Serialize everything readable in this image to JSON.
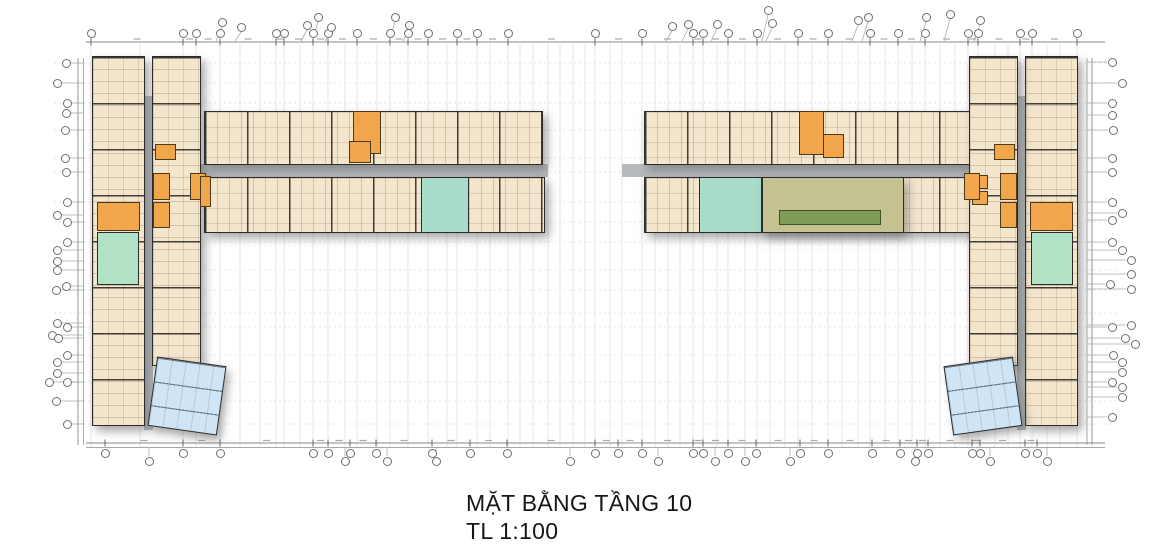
{
  "title_block": {
    "line1": "MẶT BẰNG TẦNG 10",
    "line2": "TL 1:100"
  },
  "colors": {
    "beige": "#f4e5cd",
    "wall": "#2b2b2b",
    "gray": "#b7babd",
    "orange": "#f1a64c",
    "mint": "#b2e2c5",
    "teal": "#a8dccb",
    "olive": "#c4c290",
    "balcony": "#7e9c55",
    "blue": "#cfe4f4",
    "grid": "#dcdcdc",
    "dim": "#8a8a8a",
    "tick": "#555555",
    "leader": "#aaaaaa"
  },
  "plan": {
    "blocks": [
      {
        "name": "left-wing-corridor",
        "x": 144,
        "y": 96,
        "w": 9,
        "h": 334,
        "c": "gray"
      },
      {
        "name": "left-wing-west-column",
        "x": 92,
        "y": 56,
        "w": 53,
        "h": 370,
        "c": "beige",
        "tex": "h",
        "shadow": true
      },
      {
        "name": "left-wing-east-column",
        "x": 152,
        "y": 56,
        "w": 49,
        "h": 310,
        "c": "beige",
        "tex": "h",
        "shadow": true
      },
      {
        "name": "left-wing-stair-core",
        "x": 97,
        "y": 202,
        "w": 43,
        "h": 29,
        "c": "orange"
      },
      {
        "name": "left-wing-green-unit",
        "x": 97,
        "y": 232,
        "w": 42,
        "h": 53,
        "c": "mint"
      },
      {
        "name": "left-wing-lobby",
        "x": 171,
        "y": 173,
        "w": 18,
        "h": 55,
        "c": "gray"
      },
      {
        "name": "left-wing-elevator-a",
        "x": 153,
        "y": 173,
        "w": 17,
        "h": 27,
        "c": "orange"
      },
      {
        "name": "left-wing-elevator-b",
        "x": 190,
        "y": 173,
        "w": 16,
        "h": 27,
        "c": "orange"
      },
      {
        "name": "left-wing-elevator-c",
        "x": 153,
        "y": 202,
        "w": 17,
        "h": 26,
        "c": "orange"
      },
      {
        "name": "left-wing-service-box",
        "x": 155,
        "y": 144,
        "w": 21,
        "h": 16,
        "c": "orange"
      },
      {
        "name": "left-wing-blue-unit",
        "x": 152,
        "y": 361,
        "w": 70,
        "h": 70,
        "c": "blue",
        "tex": "hl",
        "rot": 8,
        "shadow": true
      },
      {
        "name": "north-wing-left-corridor",
        "x": 144,
        "y": 164,
        "w": 404,
        "h": 13,
        "c": "gray"
      },
      {
        "name": "north-wing-left-top-row",
        "x": 204,
        "y": 111,
        "w": 339,
        "h": 54,
        "c": "beige",
        "tex": "v",
        "shadow": true
      },
      {
        "name": "north-wing-left-bottom-row",
        "x": 204,
        "y": 177,
        "w": 341,
        "h": 56,
        "c": "beige",
        "tex": "v",
        "shadow": true
      },
      {
        "name": "north-wing-left-stair-core",
        "x": 353,
        "y": 111,
        "w": 28,
        "h": 43,
        "c": "orange"
      },
      {
        "name": "north-wing-left-stair-landing",
        "x": 349,
        "y": 141,
        "w": 22,
        "h": 22,
        "c": "orange"
      },
      {
        "name": "north-wing-left-teal-unit",
        "x": 421,
        "y": 177,
        "w": 48,
        "h": 56,
        "c": "teal"
      },
      {
        "name": "north-wing-left-service-box",
        "x": 200,
        "y": 176,
        "w": 11,
        "h": 31,
        "c": "orange"
      },
      {
        "name": "north-wing-right-corridor",
        "x": 622,
        "y": 164,
        "w": 398,
        "h": 13,
        "c": "gray"
      },
      {
        "name": "north-wing-right-top-row",
        "x": 644,
        "y": 111,
        "w": 336,
        "h": 54,
        "c": "beige",
        "tex": "v",
        "shadow": true
      },
      {
        "name": "north-wing-right-bottom-row",
        "x": 644,
        "y": 177,
        "w": 336,
        "h": 56,
        "c": "beige",
        "tex": "v",
        "shadow": true
      },
      {
        "name": "north-wing-right-stair-core",
        "x": 799,
        "y": 111,
        "w": 25,
        "h": 44,
        "c": "orange"
      },
      {
        "name": "north-wing-right-stair-landing",
        "x": 823,
        "y": 134,
        "w": 21,
        "h": 24,
        "c": "orange"
      },
      {
        "name": "north-wing-right-teal-unit",
        "x": 699,
        "y": 177,
        "w": 63,
        "h": 56,
        "c": "teal"
      },
      {
        "name": "north-wing-right-olive-unit",
        "x": 762,
        "y": 177,
        "w": 142,
        "h": 56,
        "c": "olive",
        "shadow": true
      },
      {
        "name": "north-wing-right-olive-balcony",
        "x": 779,
        "y": 210,
        "w": 102,
        "h": 15,
        "c": "balcony"
      },
      {
        "name": "north-wing-right-elevator-a",
        "x": 972,
        "y": 175,
        "w": 16,
        "h": 14,
        "c": "orange"
      },
      {
        "name": "north-wing-right-elevator-b",
        "x": 972,
        "y": 191,
        "w": 16,
        "h": 14,
        "c": "orange"
      },
      {
        "name": "right-wing-corridor",
        "x": 1017,
        "y": 96,
        "w": 9,
        "h": 334,
        "c": "gray"
      },
      {
        "name": "right-wing-east-column",
        "x": 1025,
        "y": 56,
        "w": 53,
        "h": 370,
        "c": "beige",
        "tex": "h",
        "shadow": true
      },
      {
        "name": "right-wing-west-column",
        "x": 969,
        "y": 56,
        "w": 49,
        "h": 310,
        "c": "beige",
        "tex": "h",
        "shadow": true
      },
      {
        "name": "right-wing-stair-core",
        "x": 1030,
        "y": 202,
        "w": 43,
        "h": 29,
        "c": "orange"
      },
      {
        "name": "right-wing-green-unit",
        "x": 1031,
        "y": 232,
        "w": 42,
        "h": 53,
        "c": "mint"
      },
      {
        "name": "right-wing-lobby",
        "x": 981,
        "y": 173,
        "w": 18,
        "h": 55,
        "c": "gray"
      },
      {
        "name": "right-wing-elevator-a",
        "x": 1000,
        "y": 173,
        "w": 17,
        "h": 27,
        "c": "orange"
      },
      {
        "name": "right-wing-elevator-b",
        "x": 964,
        "y": 173,
        "w": 16,
        "h": 27,
        "c": "orange"
      },
      {
        "name": "right-wing-elevator-c",
        "x": 1000,
        "y": 202,
        "w": 17,
        "h": 26,
        "c": "orange"
      },
      {
        "name": "right-wing-service-box",
        "x": 994,
        "y": 144,
        "w": 21,
        "h": 16,
        "c": "orange"
      },
      {
        "name": "right-wing-blue-unit",
        "x": 948,
        "y": 361,
        "w": 70,
        "h": 70,
        "c": "blue",
        "tex": "hl",
        "rot": -8,
        "shadow": true
      }
    ]
  },
  "grid": {
    "vlines": [
      91,
      140,
      183,
      196,
      220,
      240,
      260,
      276,
      284,
      300,
      313,
      328,
      345,
      357,
      377,
      390,
      408,
      428,
      447,
      457,
      477,
      490,
      508,
      520,
      533,
      548,
      560,
      573,
      585,
      595,
      610,
      622,
      642,
      655,
      668,
      680,
      693,
      703,
      717,
      728,
      745,
      757,
      770,
      785,
      798,
      812,
      828,
      842,
      858,
      870,
      885,
      898,
      912,
      925,
      940,
      955,
      968,
      978,
      995,
      1008,
      1020,
      1032,
      1047,
      1060,
      1077
    ],
    "hlines": [
      63,
      83,
      103,
      130,
      158,
      172,
      202,
      222,
      242,
      270,
      290,
      313,
      327,
      355,
      382,
      401,
      424
    ],
    "top_bubbles": [
      91,
      183,
      196,
      220,
      276,
      284,
      313,
      328,
      357,
      390,
      408,
      428,
      457,
      477,
      508,
      595,
      642,
      693,
      703,
      728,
      757,
      798,
      828,
      870,
      898,
      925,
      968,
      978,
      1020,
      1032,
      1077
    ],
    "top_elevated": [
      {
        "x": 222,
        "y": 22
      },
      {
        "x": 241,
        "y": 27
      },
      {
        "x": 307,
        "y": 25
      },
      {
        "x": 318,
        "y": 17
      },
      {
        "x": 331,
        "y": 27
      },
      {
        "x": 395,
        "y": 17
      },
      {
        "x": 409,
        "y": 25
      },
      {
        "x": 672,
        "y": 26
      },
      {
        "x": 688,
        "y": 24
      },
      {
        "x": 717,
        "y": 24
      },
      {
        "x": 768,
        "y": 10
      },
      {
        "x": 772,
        "y": 23
      },
      {
        "x": 858,
        "y": 20
      },
      {
        "x": 868,
        "y": 17
      },
      {
        "x": 926,
        "y": 17
      },
      {
        "x": 950,
        "y": 14
      },
      {
        "x": 980,
        "y": 20
      }
    ],
    "bottom_bubbles": [
      105,
      183,
      220,
      313,
      328,
      350,
      376,
      432,
      470,
      507,
      595,
      618,
      642,
      693,
      703,
      728,
      756,
      800,
      828,
      872,
      900,
      917,
      928,
      972,
      980,
      1025,
      1037
    ],
    "bottom_dropped": [
      149,
      345,
      387,
      436,
      570,
      658,
      715,
      745,
      790,
      915,
      990,
      1047
    ],
    "left_bubbles": [
      {
        "x": 66,
        "y": 63
      },
      {
        "x": 57,
        "y": 83
      },
      {
        "x": 67,
        "y": 103
      },
      {
        "x": 66,
        "y": 113
      },
      {
        "x": 65,
        "y": 130
      },
      {
        "x": 65,
        "y": 158
      },
      {
        "x": 66,
        "y": 172
      },
      {
        "x": 67,
        "y": 202
      },
      {
        "x": 57,
        "y": 215
      },
      {
        "x": 67,
        "y": 222
      },
      {
        "x": 67,
        "y": 242
      },
      {
        "x": 57,
        "y": 250
      },
      {
        "x": 57,
        "y": 261
      },
      {
        "x": 57,
        "y": 270
      },
      {
        "x": 66,
        "y": 286
      },
      {
        "x": 56,
        "y": 290
      },
      {
        "x": 57,
        "y": 323
      },
      {
        "x": 67,
        "y": 327
      },
      {
        "x": 52,
        "y": 335
      },
      {
        "x": 58,
        "y": 338
      },
      {
        "x": 67,
        "y": 355
      },
      {
        "x": 57,
        "y": 362
      },
      {
        "x": 57,
        "y": 373
      },
      {
        "x": 49,
        "y": 382
      },
      {
        "x": 67,
        "y": 382
      },
      {
        "x": 56,
        "y": 401
      },
      {
        "x": 67,
        "y": 424
      }
    ],
    "right_bubbles": [
      {
        "x": 1112,
        "y": 62
      },
      {
        "x": 1122,
        "y": 83
      },
      {
        "x": 1112,
        "y": 103
      },
      {
        "x": 1112,
        "y": 115
      },
      {
        "x": 1113,
        "y": 130
      },
      {
        "x": 1112,
        "y": 158
      },
      {
        "x": 1112,
        "y": 172
      },
      {
        "x": 1112,
        "y": 202
      },
      {
        "x": 1122,
        "y": 213
      },
      {
        "x": 1112,
        "y": 220
      },
      {
        "x": 1112,
        "y": 242
      },
      {
        "x": 1122,
        "y": 250
      },
      {
        "x": 1131,
        "y": 260
      },
      {
        "x": 1131,
        "y": 274
      },
      {
        "x": 1110,
        "y": 284
      },
      {
        "x": 1131,
        "y": 289
      },
      {
        "x": 1131,
        "y": 325
      },
      {
        "x": 1112,
        "y": 327
      },
      {
        "x": 1125,
        "y": 338
      },
      {
        "x": 1135,
        "y": 344
      },
      {
        "x": 1113,
        "y": 355
      },
      {
        "x": 1122,
        "y": 362
      },
      {
        "x": 1122,
        "y": 372
      },
      {
        "x": 1112,
        "y": 382
      },
      {
        "x": 1122,
        "y": 387
      },
      {
        "x": 1122,
        "y": 397
      },
      {
        "x": 1112,
        "y": 417
      }
    ],
    "dim": {
      "top_y": 42,
      "bottom_y1": 443,
      "bottom_y2": 447.5,
      "left_x1": 78,
      "left_x2": 83.5,
      "right_x1": 1087,
      "right_x2": 1092,
      "h_from": 86,
      "h_to": 1105,
      "v_from": 58,
      "v_to": 445
    }
  }
}
